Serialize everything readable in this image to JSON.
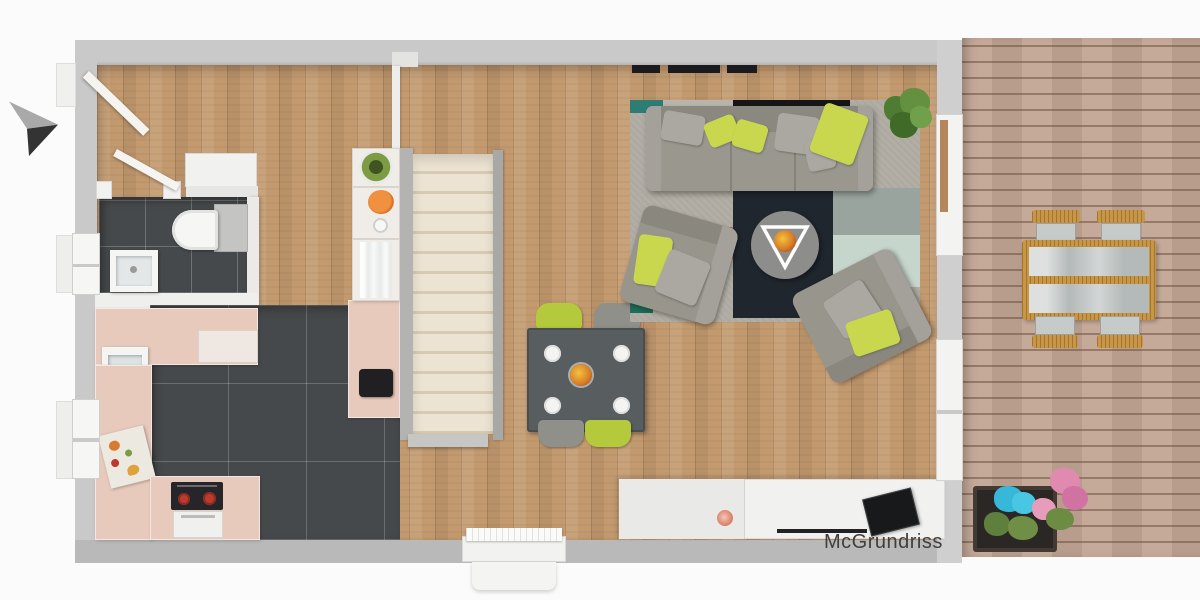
{
  "watermark": {
    "text": "McGrundriss",
    "color": "#3f3f3f"
  },
  "scene": {
    "kind": "apartment-floor-plan-top-down-render",
    "entrance_arrow": "arrow-pointing-right"
  },
  "palette": {
    "page_bg": "#fbfbfb",
    "wall": "#c9c9c9",
    "wall_bottom": "#b9b9b9",
    "wood_floor": "#c39a6f",
    "deck_wood": "#c2a593",
    "tile_dark": "#46494b",
    "counter_pink": "#e7cabc",
    "stair_tread": "#e9e0cf",
    "sofa_gray": "#9a978f",
    "pillow_lime": "#c9d74f",
    "rug_navy": "#20262e",
    "rug_teal": "#2e7d74",
    "rug_mint": "#c6d6cd",
    "dining_table": "#585d60",
    "chair_lime": "#b4ca3c",
    "chair_gray": "#90908a",
    "outdoor_tan": "#c79747",
    "flower_cyan": "#37b8d8",
    "flower_pink": "#e08ab0",
    "stove_red": "#bb3b2e"
  },
  "inventory": {
    "dining_chairs": 4,
    "dining_plates": 4,
    "outdoor_chairs": 4,
    "armchairs": 2,
    "sofa_pillows": 6
  }
}
